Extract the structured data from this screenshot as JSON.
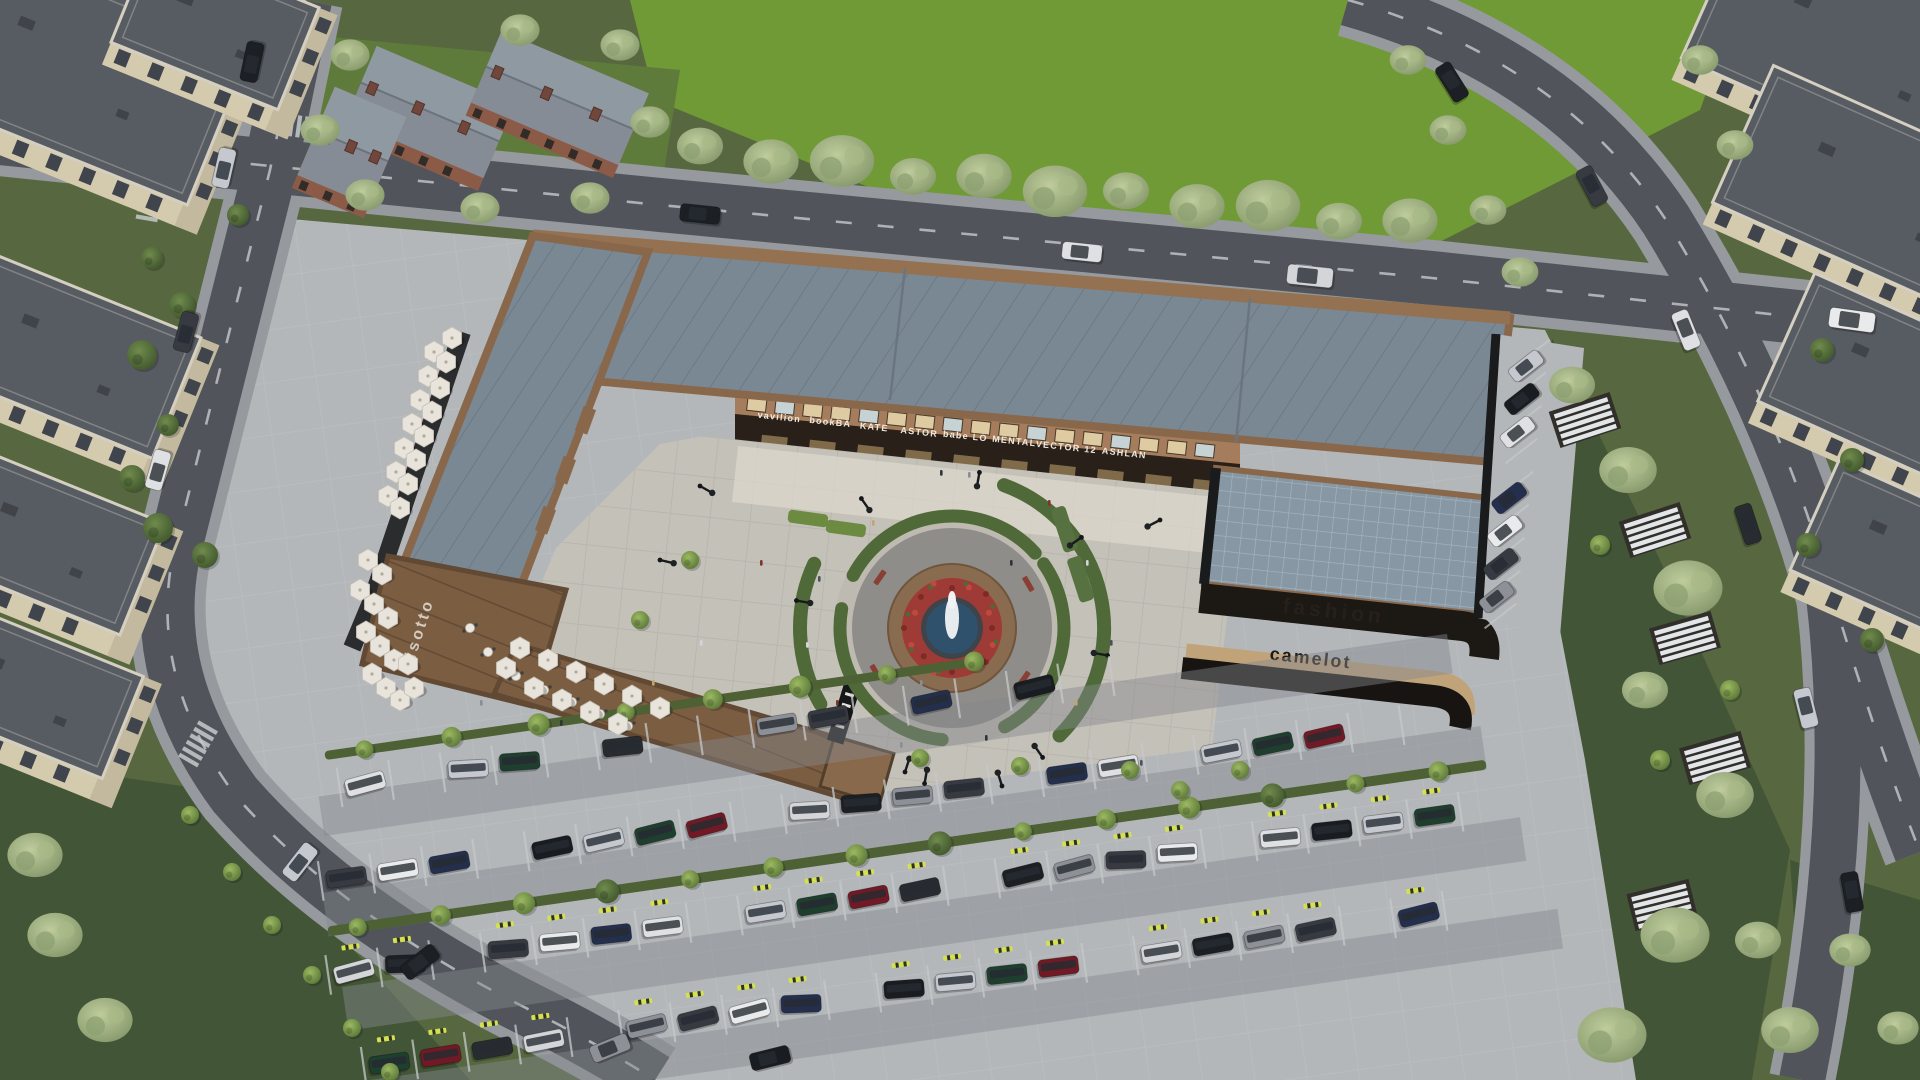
{
  "scene": {
    "type": "aerial-architectural-render",
    "description": "Dusk aerial 3D rendering of an angular timber-and-metal shopping center enclosing a circular fountain plaza, with outdoor cafe umbrellas, large striped parking lot full of cars, perimeter roads, lawns with pergolas, brick cottages and cream apartment blocks around the edges"
  },
  "signage": {
    "left_wing_vertical": "risotto",
    "inner_facade_shops": [
      "vavilion",
      "bookBA",
      "KATE",
      "ASTOR",
      "babe LO",
      "MENTAL",
      "VECTOR 12",
      "ASHLAN"
    ],
    "right_building_upper": "fashion",
    "right_building_lower": "camelot"
  },
  "colors": {
    "field_green": "#6f9a2f",
    "lawn_green": "#55663a",
    "lawn_dark": "#3f5230",
    "road_asphalt": "#4e5257",
    "sidewalk": "#97999c",
    "site_pavement": "#b7b9bb",
    "plaza_pavement": "#c8c3ba",
    "plaza_light": "#e4ddd0",
    "roof_metal": "#7a8793",
    "roof_wood": "#7b5a3d",
    "wood_trim": "#8a6546",
    "facade_tan": "#a87c58",
    "facade_dark": "#241a11",
    "window_glow": "#e8d6a8",
    "glass_roof": "#8798a4",
    "residential_wall": "#d9cdae",
    "residential_wall_shade": "#c7bb9d",
    "residential_roof": "#55585e",
    "brick_wall": "#8d5843",
    "brick_roof": "#9099a2",
    "fountain_water": "#2c4d68",
    "flower_red": "#a03630",
    "hedge_green": "#4c6832",
    "umbrella_white": "#eee8de",
    "wheel_stop": "#d9e44c",
    "road_paint": "#c9ccce",
    "sign_text_light": "#f5efe2",
    "sign_text_dark": "#241b12"
  },
  "vehicle_palette": [
    "#e3e4e6",
    "#17191c",
    "#c9cbd0",
    "#33363c",
    "#70141f",
    "#1e2a47",
    "#d8d9db",
    "#14161a",
    "#8e9196",
    "#1a3a28",
    "#efefef",
    "#23252a"
  ]
}
